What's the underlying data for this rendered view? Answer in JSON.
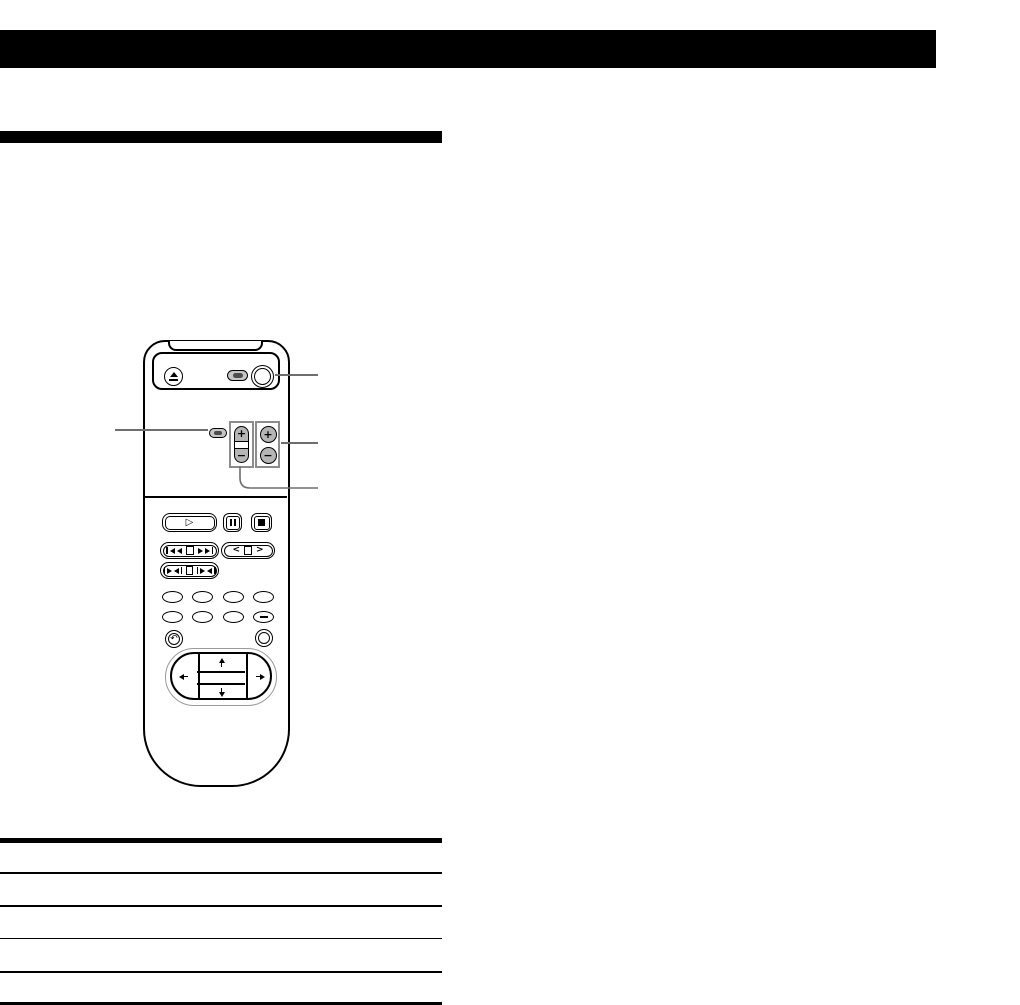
{
  "page": {
    "background": "#ffffff"
  },
  "top_banner": {
    "color": "#000000"
  },
  "section_heading_bar": {
    "color": "#000000"
  },
  "remote": {
    "glyphs": {
      "plus": "+",
      "minus": "−",
      "play": "▷",
      "nav_left": "<",
      "nav_right": ">",
      "return": "↶"
    },
    "button_fill": "#b5b5b5",
    "box_border": "#8c8c8c"
  },
  "callouts": {
    "color": "#6e6e6e",
    "count": 4
  },
  "table": {
    "rule_color": "#000000",
    "row_count": 5,
    "has_header_rule": true
  }
}
